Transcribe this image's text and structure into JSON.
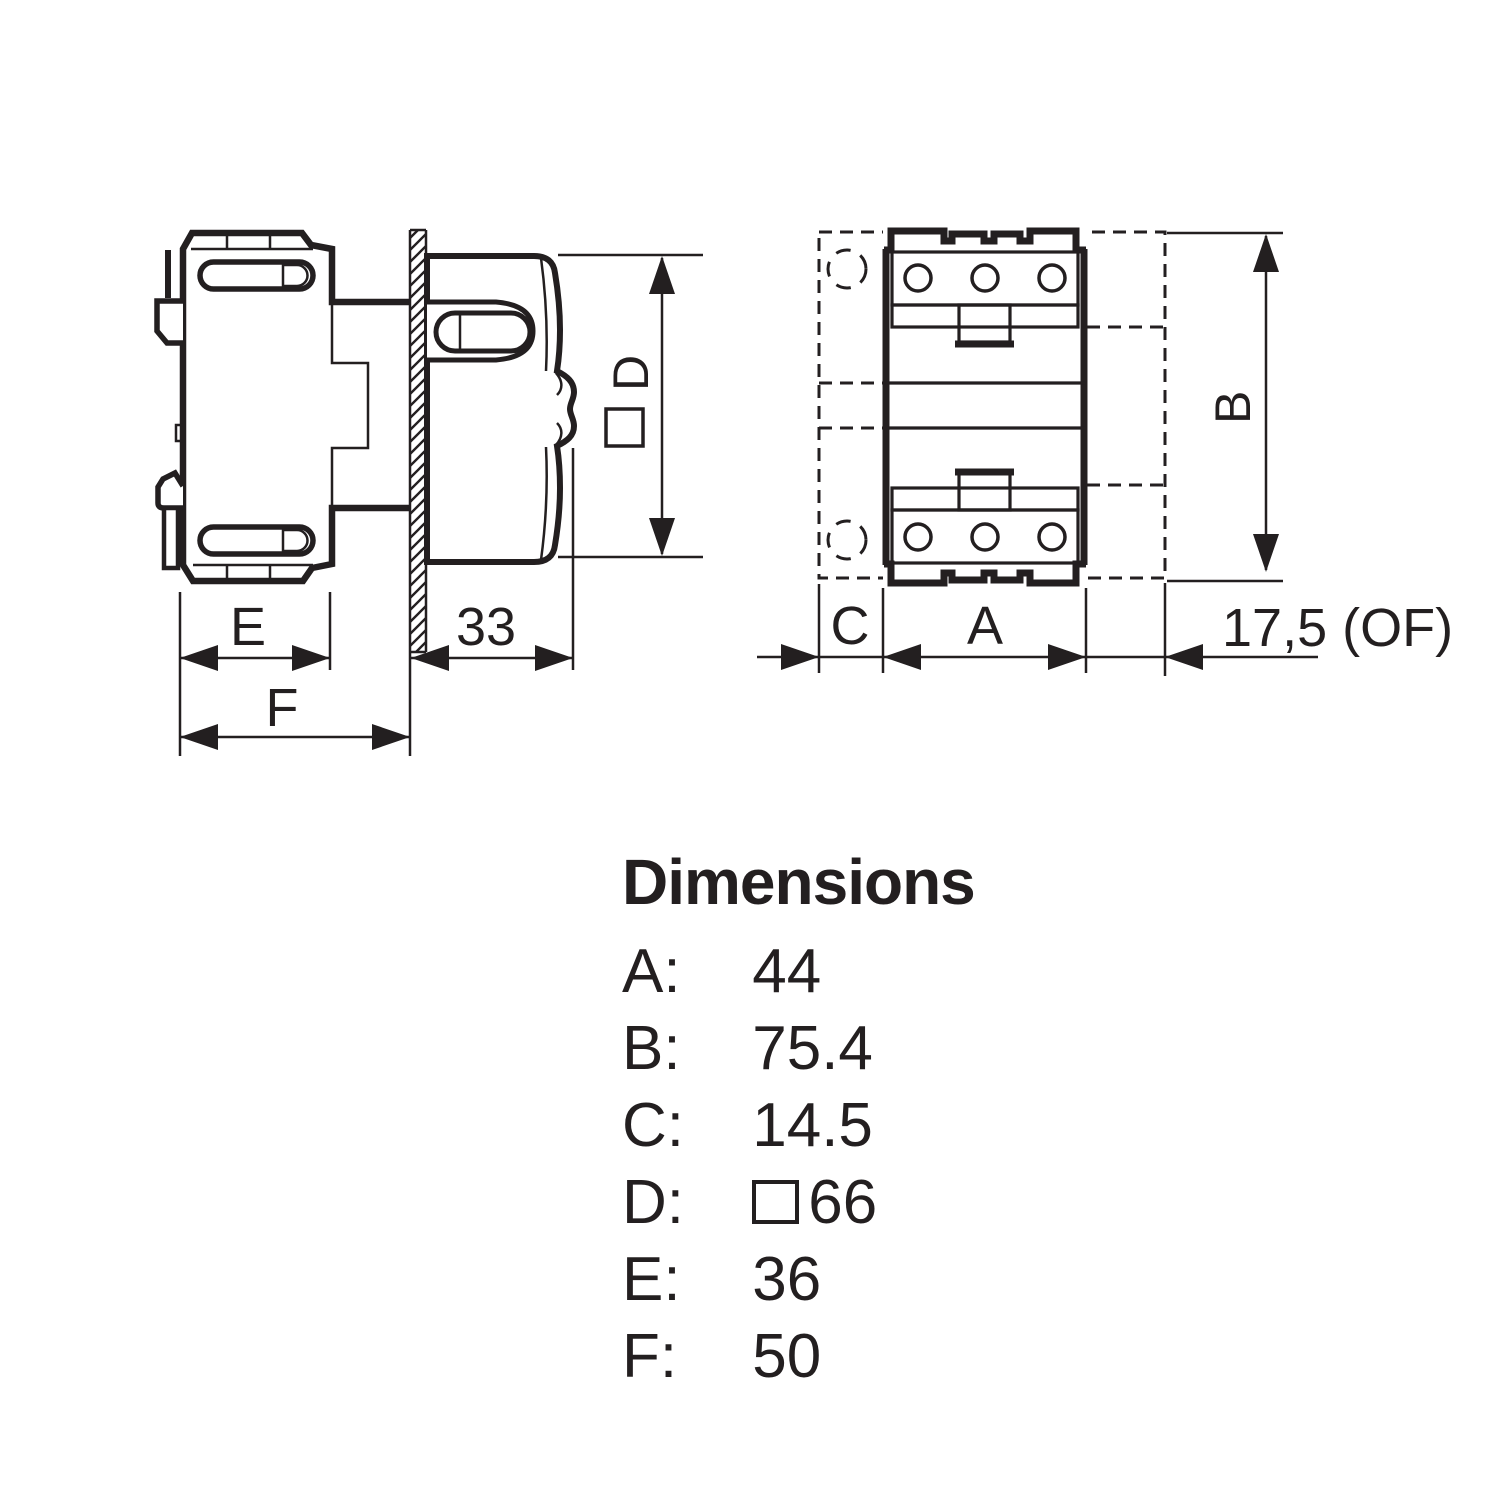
{
  "colors": {
    "ink": "#231f20",
    "background": "#ffffff"
  },
  "side_view": {
    "dim_e": "E",
    "dim_f": "F",
    "dim_knob_depth": "33",
    "dim_d": "D",
    "dim_d_square_symbol": "□"
  },
  "front_view": {
    "dim_a": "A",
    "dim_b": "B",
    "dim_c": "C",
    "dim_of": "17,5 (OF)"
  },
  "legend": {
    "title": "Dimensions",
    "rows": [
      {
        "label": "A:",
        "value": "44"
      },
      {
        "label": "B:",
        "value": "75.4"
      },
      {
        "label": "C:",
        "value": "14.5"
      },
      {
        "label": "D:",
        "value": "66",
        "square_symbol": "□"
      },
      {
        "label": "E:",
        "value": "36"
      },
      {
        "label": "F:",
        "value": "50"
      }
    ]
  }
}
